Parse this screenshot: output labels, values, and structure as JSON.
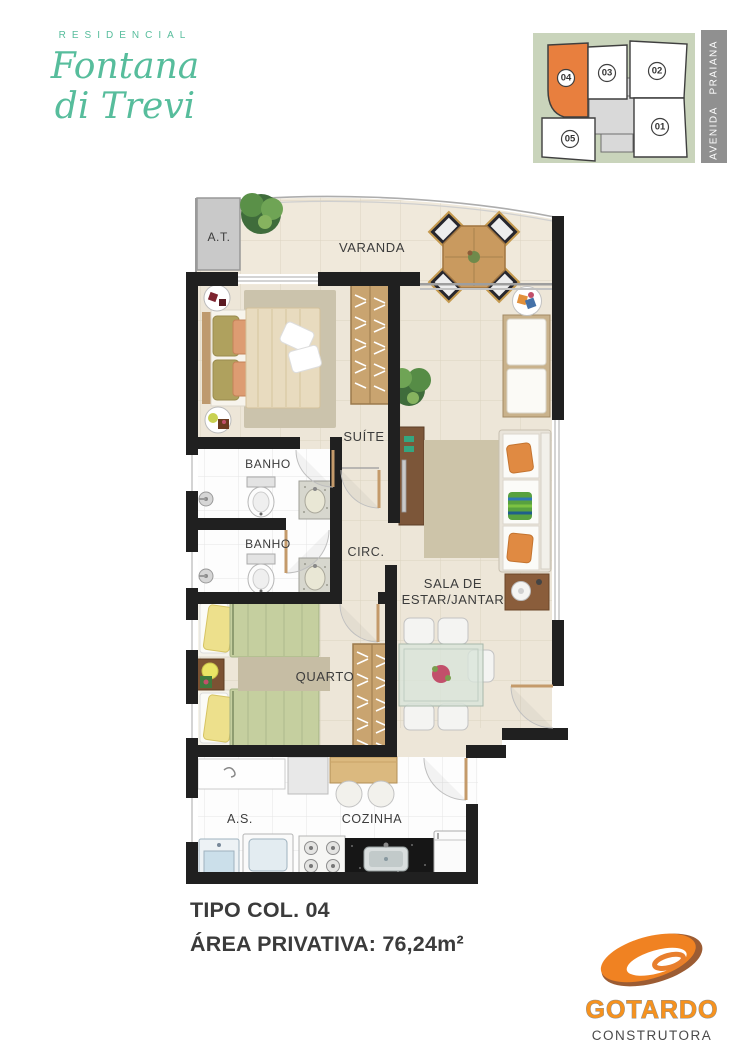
{
  "brand": {
    "kicker": "RESIDENCIAL",
    "script_line1": "Fontana",
    "script_line2": "di Trevi"
  },
  "site_map": {
    "street_label": "AVENIDA PRAIANA",
    "highlighted_unit": "04",
    "units": [
      {
        "number": "04",
        "highlighted": true
      },
      {
        "number": "03",
        "highlighted": false
      },
      {
        "number": "02",
        "highlighted": false
      },
      {
        "number": "05",
        "highlighted": false
      },
      {
        "number": "01",
        "highlighted": false
      }
    ],
    "colors": {
      "background": "#C9D4BB",
      "highlight": "#E87F3E",
      "core": "#D9D9D9",
      "street_strip": "#909090"
    }
  },
  "floor_plan": {
    "rooms": {
      "at": "A.T.",
      "varanda": "VARANDA",
      "suite": "SUÍTE",
      "banho_suite": "BANHO",
      "banho_social": "BANHO",
      "circ": "CIRC.",
      "quarto": "QUARTO",
      "sala_line1": "SALA DE",
      "sala_line2": "ESTAR/JANTAR",
      "servico": "A.S.",
      "cozinha": "COZINHA"
    }
  },
  "summary": {
    "type_label": "TIPO COL. 04",
    "area_label": "ÁREA PRIVATIVA: 76,24m²"
  },
  "builder": {
    "name": "GOTARDO",
    "tagline": "CONSTRUTORA",
    "colors": {
      "orange": "#F6921E",
      "brown": "#9C5C33",
      "text": "#4A4A4A"
    }
  }
}
